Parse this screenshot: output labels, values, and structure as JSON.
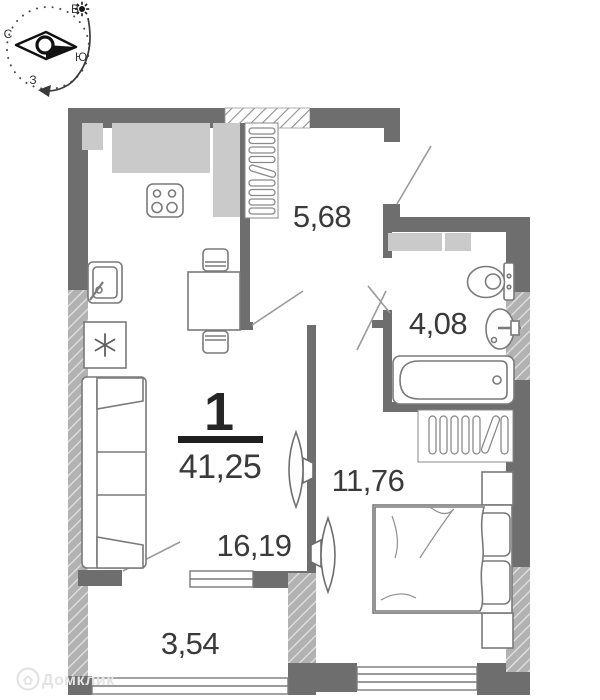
{
  "plan": {
    "unit_number": "1",
    "total_area": "41,25",
    "rooms": [
      {
        "key": "hallway",
        "area": "5,68"
      },
      {
        "key": "bathroom",
        "area": "4,08"
      },
      {
        "key": "bedroom",
        "area": "11,76"
      },
      {
        "key": "living-kitchen",
        "area": "16,19"
      },
      {
        "key": "balcony",
        "area": "3,54"
      }
    ]
  },
  "compass": {
    "letters": {
      "top": "В",
      "left": "С",
      "right": "Ю",
      "bottom": "З"
    }
  },
  "watermark": {
    "text": "Домклик"
  },
  "colors": {
    "wall": "#6e6e6e",
    "hatch_wall_base": "#b2b2b2",
    "furniture_fill": "#cacaca",
    "outline": "#7a7a7a",
    "label_text": "#3a3a3a",
    "watermark": "#e3e3e3"
  }
}
